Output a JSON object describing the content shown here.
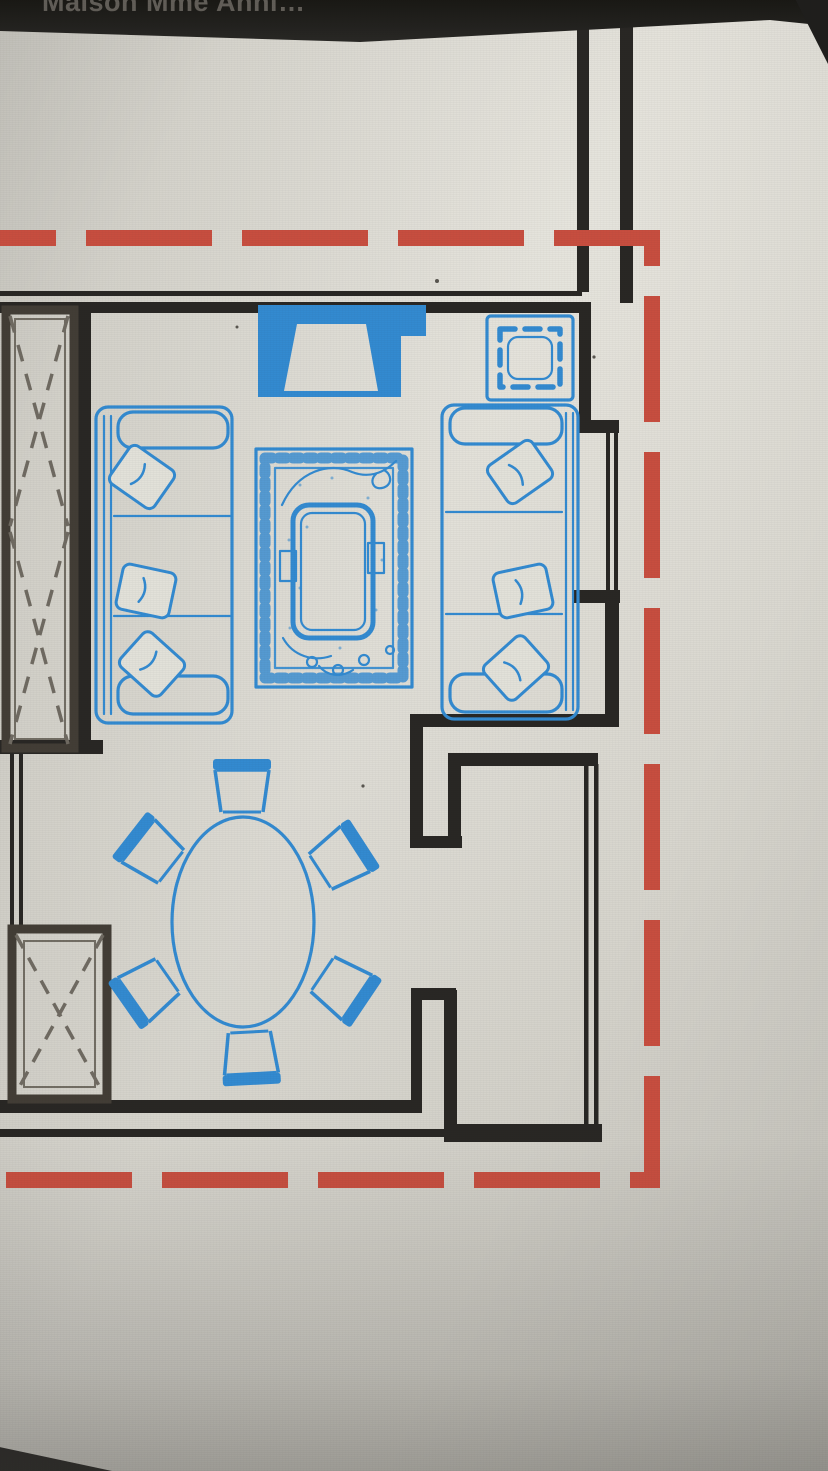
{
  "window": {
    "title": "Maison Mme Anni…"
  },
  "colors": {
    "titlebar_bg": "#1b1a18",
    "title_text": "#5e5a54",
    "screen_bg": "#d9d7cf",
    "wall_black": "#24221f",
    "wardrobe_outline": "#3e3931",
    "furniture_blue": "#2e87cf",
    "boundary_red": "#c64a3b"
  },
  "floorplan": {
    "boundary_style": "red-dashed-rectangle",
    "furniture_icons": [
      {
        "name": "tv-unit-icon"
      },
      {
        "name": "square-side-table-icon"
      },
      {
        "name": "three-seat-sofa-left-icon"
      },
      {
        "name": "three-seat-sofa-right-icon"
      },
      {
        "name": "patterned-rug-icon"
      },
      {
        "name": "coffee-table-icon"
      },
      {
        "name": "oval-dining-table-icon"
      },
      {
        "name": "dining-chair-icon",
        "count": 6
      },
      {
        "name": "wardrobe-crossed-icon"
      },
      {
        "name": "closet-crossed-icon"
      }
    ],
    "dining_chair_count": 6,
    "sofa_count": 2,
    "throw_pillow_count": 6
  }
}
